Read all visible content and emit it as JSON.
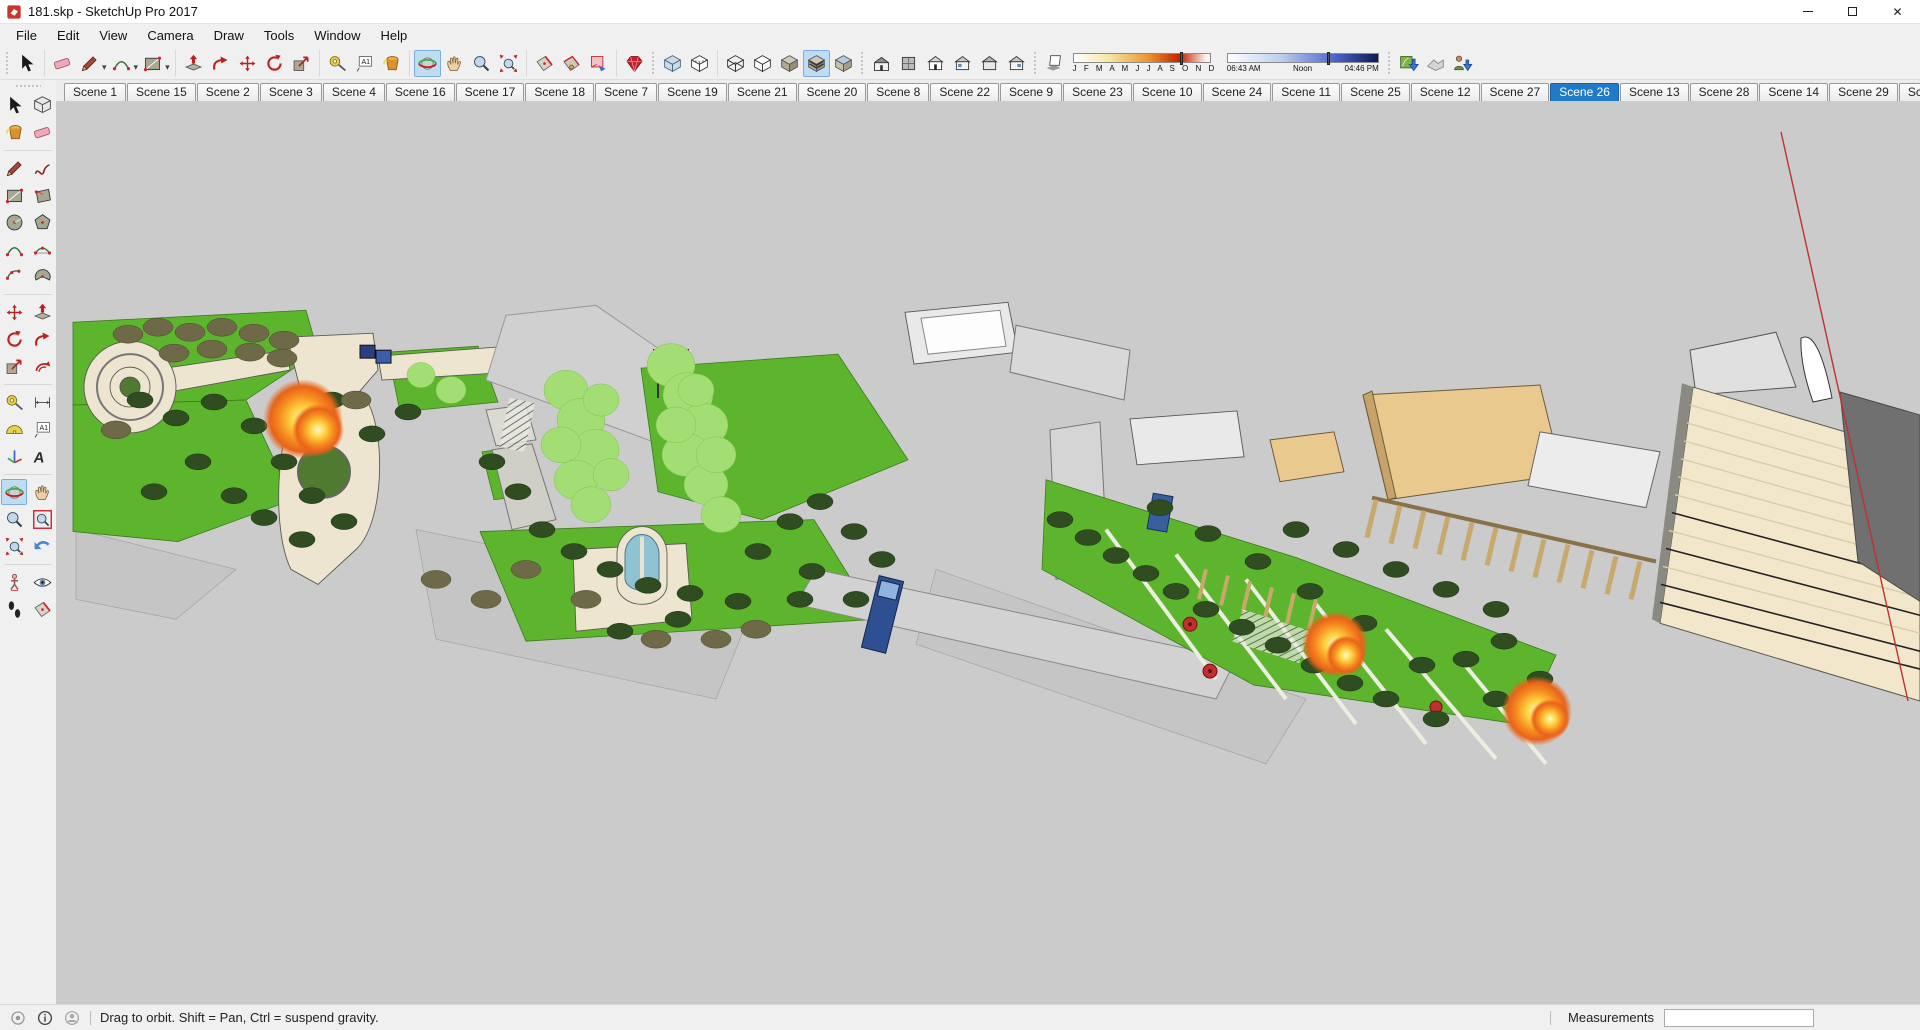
{
  "window": {
    "title": "181.skp - SketchUp Pro 2017",
    "controls": {
      "minimize": "minimize",
      "restore": "restore",
      "close": "close"
    }
  },
  "menu": {
    "items": [
      "File",
      "Edit",
      "View",
      "Camera",
      "Draw",
      "Tools",
      "Window",
      "Help"
    ]
  },
  "toolbar": {
    "groups": [
      {
        "handle": true,
        "items": [
          {
            "name": "select",
            "icon": "cursor"
          }
        ]
      },
      {
        "items": [
          {
            "name": "eraser",
            "icon": "eraser"
          },
          {
            "name": "line",
            "icon": "pencil",
            "dropdown": true
          },
          {
            "name": "arc",
            "icon": "arc",
            "dropdown": true
          },
          {
            "name": "rectangle",
            "icon": "rect",
            "dropdown": true
          }
        ]
      },
      {
        "items": [
          {
            "name": "push-pull",
            "icon": "pushpull"
          },
          {
            "name": "follow-me",
            "icon": "followme"
          },
          {
            "name": "move",
            "icon": "move"
          },
          {
            "name": "rotate",
            "icon": "rotate"
          },
          {
            "name": "scale",
            "icon": "scale"
          }
        ]
      },
      {
        "items": [
          {
            "name": "tape-measure",
            "icon": "tape"
          },
          {
            "name": "text",
            "icon": "text"
          },
          {
            "name": "paint-bucket",
            "icon": "bucket"
          }
        ]
      },
      {
        "items": [
          {
            "name": "orbit",
            "icon": "orbit",
            "selected": true
          },
          {
            "name": "pan",
            "icon": "pan"
          },
          {
            "name": "zoom",
            "icon": "zoom"
          },
          {
            "name": "zoom-extents",
            "icon": "zoomext"
          }
        ]
      },
      {
        "items": [
          {
            "name": "section-plane",
            "icon": "section"
          },
          {
            "name": "display-section-planes",
            "icon": "sectionp"
          },
          {
            "name": "display-section-cuts",
            "icon": "sectionc"
          }
        ]
      },
      {
        "items": [
          {
            "name": "ruby-extension",
            "icon": "gem"
          }
        ]
      },
      {
        "handle": true,
        "items": [
          {
            "name": "x-ray",
            "icon": "cubexray"
          },
          {
            "name": "back-edges",
            "icon": "cubeback"
          }
        ]
      },
      {
        "items": [
          {
            "name": "wireframe",
            "icon": "cubewire"
          },
          {
            "name": "hidden-line",
            "icon": "cubehidden"
          },
          {
            "name": "shaded",
            "icon": "cubeshaded"
          },
          {
            "name": "shaded-with-textures",
            "icon": "cubetex",
            "selected": true
          },
          {
            "name": "monochrome",
            "icon": "cubemono"
          }
        ]
      },
      {
        "handle": true,
        "items": [
          {
            "name": "iso-view",
            "icon": "houseiso"
          },
          {
            "name": "top-view",
            "icon": "housetop"
          },
          {
            "name": "front-view",
            "icon": "housefront"
          },
          {
            "name": "right-view",
            "icon": "houseright"
          },
          {
            "name": "back-view",
            "icon": "houseback"
          },
          {
            "name": "left-view",
            "icon": "houseleft"
          }
        ]
      },
      {
        "handle": true,
        "shadows": true,
        "items": [
          {
            "name": "toggle-shadows",
            "icon": "shadowtog"
          }
        ]
      },
      {
        "handle": true,
        "items": [
          {
            "name": "add-location",
            "icon": "addloc"
          },
          {
            "name": "toggle-terrain",
            "icon": "terrain"
          },
          {
            "name": "photo-textures",
            "icon": "phototex"
          }
        ]
      }
    ],
    "shadow_settings": {
      "months": "J F M A M J J A S O N D",
      "date_position": 0.78,
      "time_start": "06:43 AM",
      "time_noon": "Noon",
      "time_end": "04:46 PM",
      "time_position": 0.66
    }
  },
  "scene_tabs": {
    "active": "Scene 26",
    "tabs": [
      "Scene 1",
      "Scene 15",
      "Scene 2",
      "Scene 3",
      "Scene 4",
      "Scene 16",
      "Scene 17",
      "Scene 18",
      "Scene 7",
      "Scene 19",
      "Scene 21",
      "Scene 20",
      "Scene 8",
      "Scene 22",
      "Scene 9",
      "Scene 23",
      "Scene 10",
      "Scene 24",
      "Scene 11",
      "Scene 25",
      "Scene 12",
      "Scene 27",
      "Scene 26",
      "Scene 13",
      "Scene 28",
      "Scene 14",
      "Scene 29",
      "Scene 30"
    ]
  },
  "tool_palette": {
    "rows": [
      [
        {
          "name": "select",
          "icon": "cursor"
        },
        {
          "name": "make-component",
          "icon": "component"
        }
      ],
      [
        {
          "name": "paint-bucket",
          "icon": "bucket"
        },
        {
          "name": "eraser",
          "icon": "eraser"
        }
      ],
      "sep",
      [
        {
          "name": "line",
          "icon": "pencil"
        },
        {
          "name": "freehand",
          "icon": "freehand"
        }
      ],
      [
        {
          "name": "rectangle",
          "icon": "rect"
        },
        {
          "name": "rotated-rectangle",
          "icon": "rotrect"
        }
      ],
      [
        {
          "name": "circle",
          "icon": "circle"
        },
        {
          "name": "polygon",
          "icon": "polygon"
        }
      ],
      [
        {
          "name": "arc",
          "icon": "arc"
        },
        {
          "name": "two-point-arc",
          "icon": "arc2"
        }
      ],
      [
        {
          "name": "three-point-arc",
          "icon": "arc3"
        },
        {
          "name": "pie",
          "icon": "pie"
        }
      ],
      "sep",
      [
        {
          "name": "move",
          "icon": "move"
        },
        {
          "name": "push-pull",
          "icon": "pushpull"
        }
      ],
      [
        {
          "name": "rotate",
          "icon": "rotate"
        },
        {
          "name": "follow-me",
          "icon": "followme"
        }
      ],
      [
        {
          "name": "scale",
          "icon": "scale"
        },
        {
          "name": "offset",
          "icon": "offset"
        }
      ],
      "sep",
      [
        {
          "name": "tape-measure",
          "icon": "tape"
        },
        {
          "name": "dimension",
          "icon": "dimension"
        }
      ],
      [
        {
          "name": "protractor",
          "icon": "protractor"
        },
        {
          "name": "text",
          "icon": "text"
        }
      ],
      [
        {
          "name": "axes",
          "icon": "axes"
        },
        {
          "name": "3d-text",
          "icon": "text3d"
        }
      ],
      "sep",
      [
        {
          "name": "orbit",
          "icon": "orbit",
          "selected": true
        },
        {
          "name": "pan",
          "icon": "pan"
        }
      ],
      [
        {
          "name": "zoom",
          "icon": "zoom"
        },
        {
          "name": "zoom-window",
          "icon": "zoomwin"
        }
      ],
      [
        {
          "name": "zoom-extents",
          "icon": "zoomext"
        },
        {
          "name": "previous",
          "icon": "previous"
        }
      ],
      "sep",
      [
        {
          "name": "position-camera",
          "icon": "poscam"
        },
        {
          "name": "look-around",
          "icon": "eye"
        }
      ],
      [
        {
          "name": "walk",
          "icon": "walk"
        },
        {
          "name": "section-plane",
          "icon": "section"
        }
      ]
    ]
  },
  "statusbar": {
    "icons": [
      "geolocation",
      "model-info",
      "sign-in"
    ],
    "hint": "Drag to orbit. Shift = Pan, Ctrl = suspend gravity.",
    "measurements_label": "Measurements",
    "measurements_value": ""
  },
  "colors": {
    "viewport_bg": "#CBCBCB",
    "lawn_green": "#5CB52C",
    "tree_dark": "#2F4D20",
    "tree_olive": "#6E6A47",
    "tree_light": "#A2DE74",
    "path_cream": "#EDE5D0",
    "roof_tan": "#E9C98E",
    "stair_cream": "#F2E7CB",
    "wall_dark": "#707070",
    "fire_orange": "#F07F1E",
    "water_blue": "#8FC3D4",
    "vehicle_blue": "#2E4F92",
    "axis_red": "#C03030",
    "active_tab_blue": "#1F7BC8",
    "tool_highlight": "#BFDDF2"
  }
}
